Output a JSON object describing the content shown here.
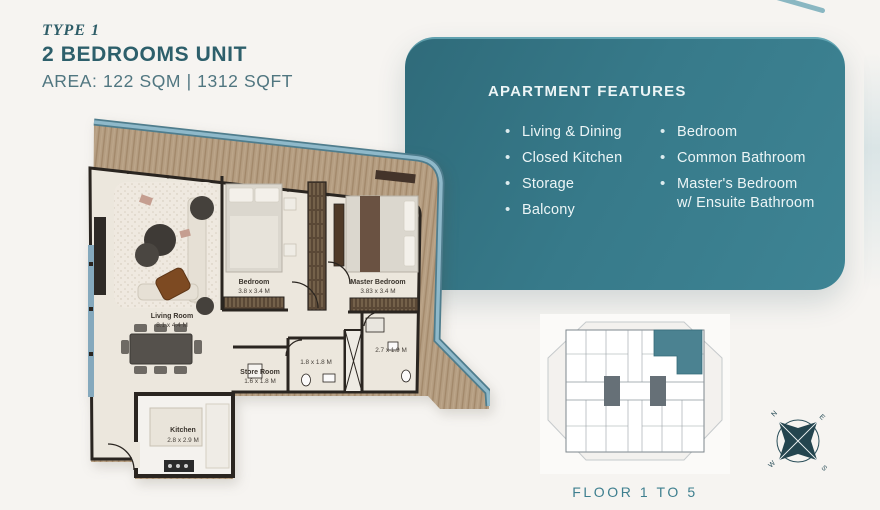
{
  "header": {
    "type_label": "TYPE 1",
    "unit_title": "2 BEDROOMS UNIT",
    "area_label": "AREA: 122 SQM | 1312 SQFT"
  },
  "features": {
    "title": "APARTMENT FEATURES",
    "left": [
      "Living & Dining",
      "Closed Kitchen",
      "Storage",
      "Balcony"
    ],
    "right": [
      "Bedroom",
      "Common Bathroom",
      "Master's Bedroom",
      "w/ Ensuite Bathroom"
    ]
  },
  "floor_plan": {
    "rooms": {
      "living": {
        "name": "Living Room",
        "dims": "8.1 x 4.4 M"
      },
      "bedroom": {
        "name": "Bedroom",
        "dims": "3.8 x 3.4 M"
      },
      "master": {
        "name": "Master Bedroom",
        "dims": "3.83 x 3.4 M"
      },
      "store": {
        "name": "Store Room",
        "dims": "1.6 x 1.8 M"
      },
      "bathroom": {
        "dims": "1.8 x 1.8 M"
      },
      "master_bath": {
        "dims": "2.7 x 1.9 M"
      },
      "kitchen": {
        "name": "Kitchen",
        "dims": "2.8 x 2.9 M"
      }
    }
  },
  "key_plan": {
    "caption": "FLOOR 1 TO 5"
  },
  "compass": {
    "north": "N",
    "east": "E",
    "south": "S",
    "west": "W"
  },
  "colors": {
    "panel_teal": "#37798A",
    "title_teal": "#2D5F6B",
    "caption_teal": "#3E7F8F",
    "unit_highlight": "#4B8291",
    "balcony_rail": "#8FB9CA",
    "wood_deck": "#B59E82"
  }
}
